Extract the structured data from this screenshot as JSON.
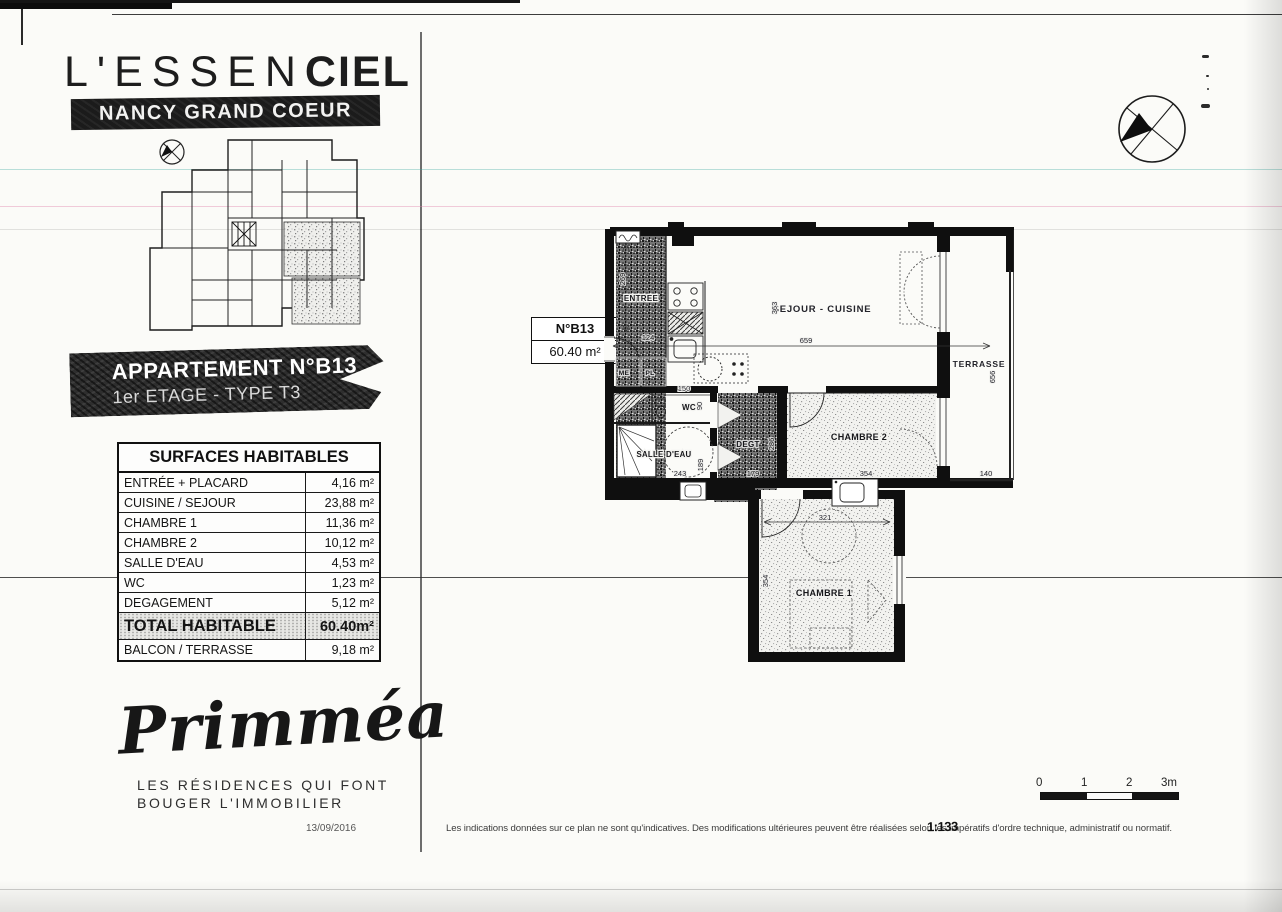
{
  "header": {
    "title_regular": "L'ESSEN",
    "title_bold": "CIEL",
    "location_banner": "NANCY GRAND COEUR"
  },
  "apartment_banner": {
    "line1": "APPARTEMENT N°B13",
    "line2": "1er ETAGE - TYPE T3"
  },
  "surfaces_table": {
    "header": "SURFACES HABITABLES",
    "rows": [
      {
        "label": "ENTRÉE + PLACARD",
        "value": "4,16 m²"
      },
      {
        "label": "CUISINE / SEJOUR",
        "value": "23,88 m²"
      },
      {
        "label": "CHAMBRE 1",
        "value": "11,36 m²"
      },
      {
        "label": "CHAMBRE 2",
        "value": "10,12 m²"
      },
      {
        "label": "SALLE D'EAU",
        "value": "4,53 m²"
      },
      {
        "label": "WC",
        "value": "1,23 m²"
      },
      {
        "label": "DEGAGEMENT",
        "value": "5,12 m²"
      }
    ],
    "total_row": {
      "label": "TOTAL HABITABLE",
      "value": "60.40m²"
    },
    "balcony_row": {
      "label": "BALCON / TERRASSE",
      "value": "9,18 m²"
    }
  },
  "unit_label": {
    "number": "N°B13",
    "area": "60.40 m²"
  },
  "plan": {
    "rooms": {
      "entree": "ENTREE",
      "sejour_cuisine": "SEJOUR - CUISINE",
      "terrasse": "TERRASSE",
      "wc": "WC",
      "salle_eau": "SALLE D'EAU",
      "degagement": "DEGT",
      "chambre2": "CHAMBRE 2",
      "chambre1": "CHAMBRE 1",
      "me": "ME",
      "pl": "PL"
    },
    "dimensions": {
      "entree_height": "269",
      "entree_door": "124",
      "wc_width": "150",
      "wc_depth": "90",
      "salle_eau_width": "243",
      "salle_eau_depth": "189",
      "degagement_width": "179",
      "degagement_height": "286",
      "sejour_width": "659",
      "sejour_height": "363",
      "chambre2_width": "354",
      "terrasse_height": "656",
      "terrasse_width": "140",
      "chambre1_width": "321",
      "chambre1_height": "354"
    }
  },
  "scale_bar": {
    "tick0": "0",
    "tick1": "1",
    "tick2": "2",
    "tick3": "3m"
  },
  "logo": {
    "brand": "Primméa",
    "tagline_line1": "LES RÉSIDENCES QUI FONT",
    "tagline_line2": "BOUGER L'IMMOBILIER"
  },
  "footer": {
    "date": "13/09/2016",
    "disclaimer": "Les indications données sur ce plan ne sont qu'indicatives. Des modifications ultérieures peuvent être réalisées selon les impératifs d'ordre technique, administratif ou normatif.",
    "stamp": "1:133"
  }
}
